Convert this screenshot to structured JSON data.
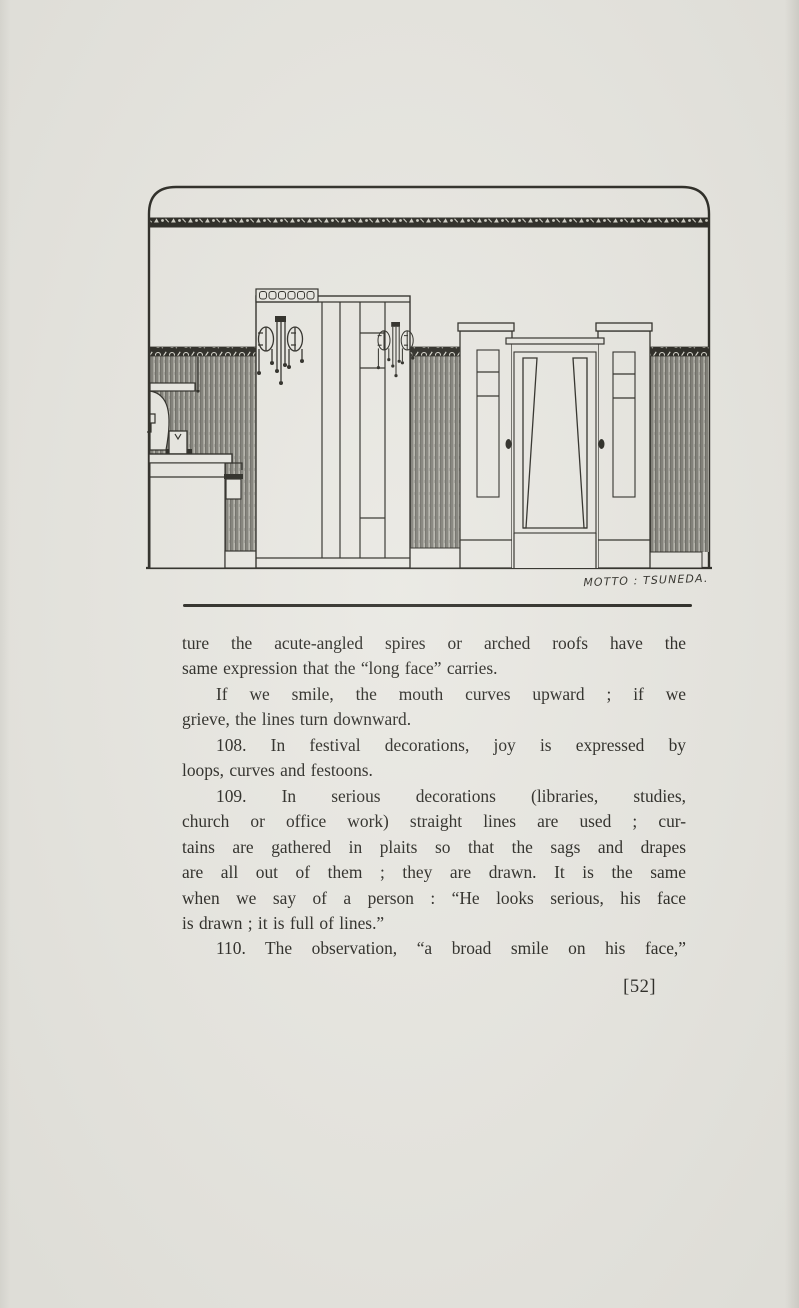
{
  "colors": {
    "paper": "#e8e7e1",
    "ink": "#26251f",
    "stripe": "#9c9b93",
    "band": "#23221c"
  },
  "illustration": {
    "signature": "MOTTO : TSUNEDA."
  },
  "body": {
    "lines": [
      "ture the acute-angled spires or arched roofs have the",
      "same expression that the “long face” carries.",
      "If we smile, the mouth curves upward ; if we",
      "grieve, the lines turn downward.",
      "108. In festival decorations, joy is expressed by",
      "loops, curves and festoons.",
      "109. In serious decorations (libraries, studies,",
      "church or office work) straight lines are used ; cur-",
      "tains are gathered in plaits so that the sags and drapes",
      "are all out of them ; they are drawn.  It is the same",
      "when we say of a person :  “He looks serious, his face",
      "is drawn ; it is full of lines.”",
      "110.  The observation, “a broad smile on his face,”"
    ]
  },
  "page": {
    "number": "[52]"
  }
}
